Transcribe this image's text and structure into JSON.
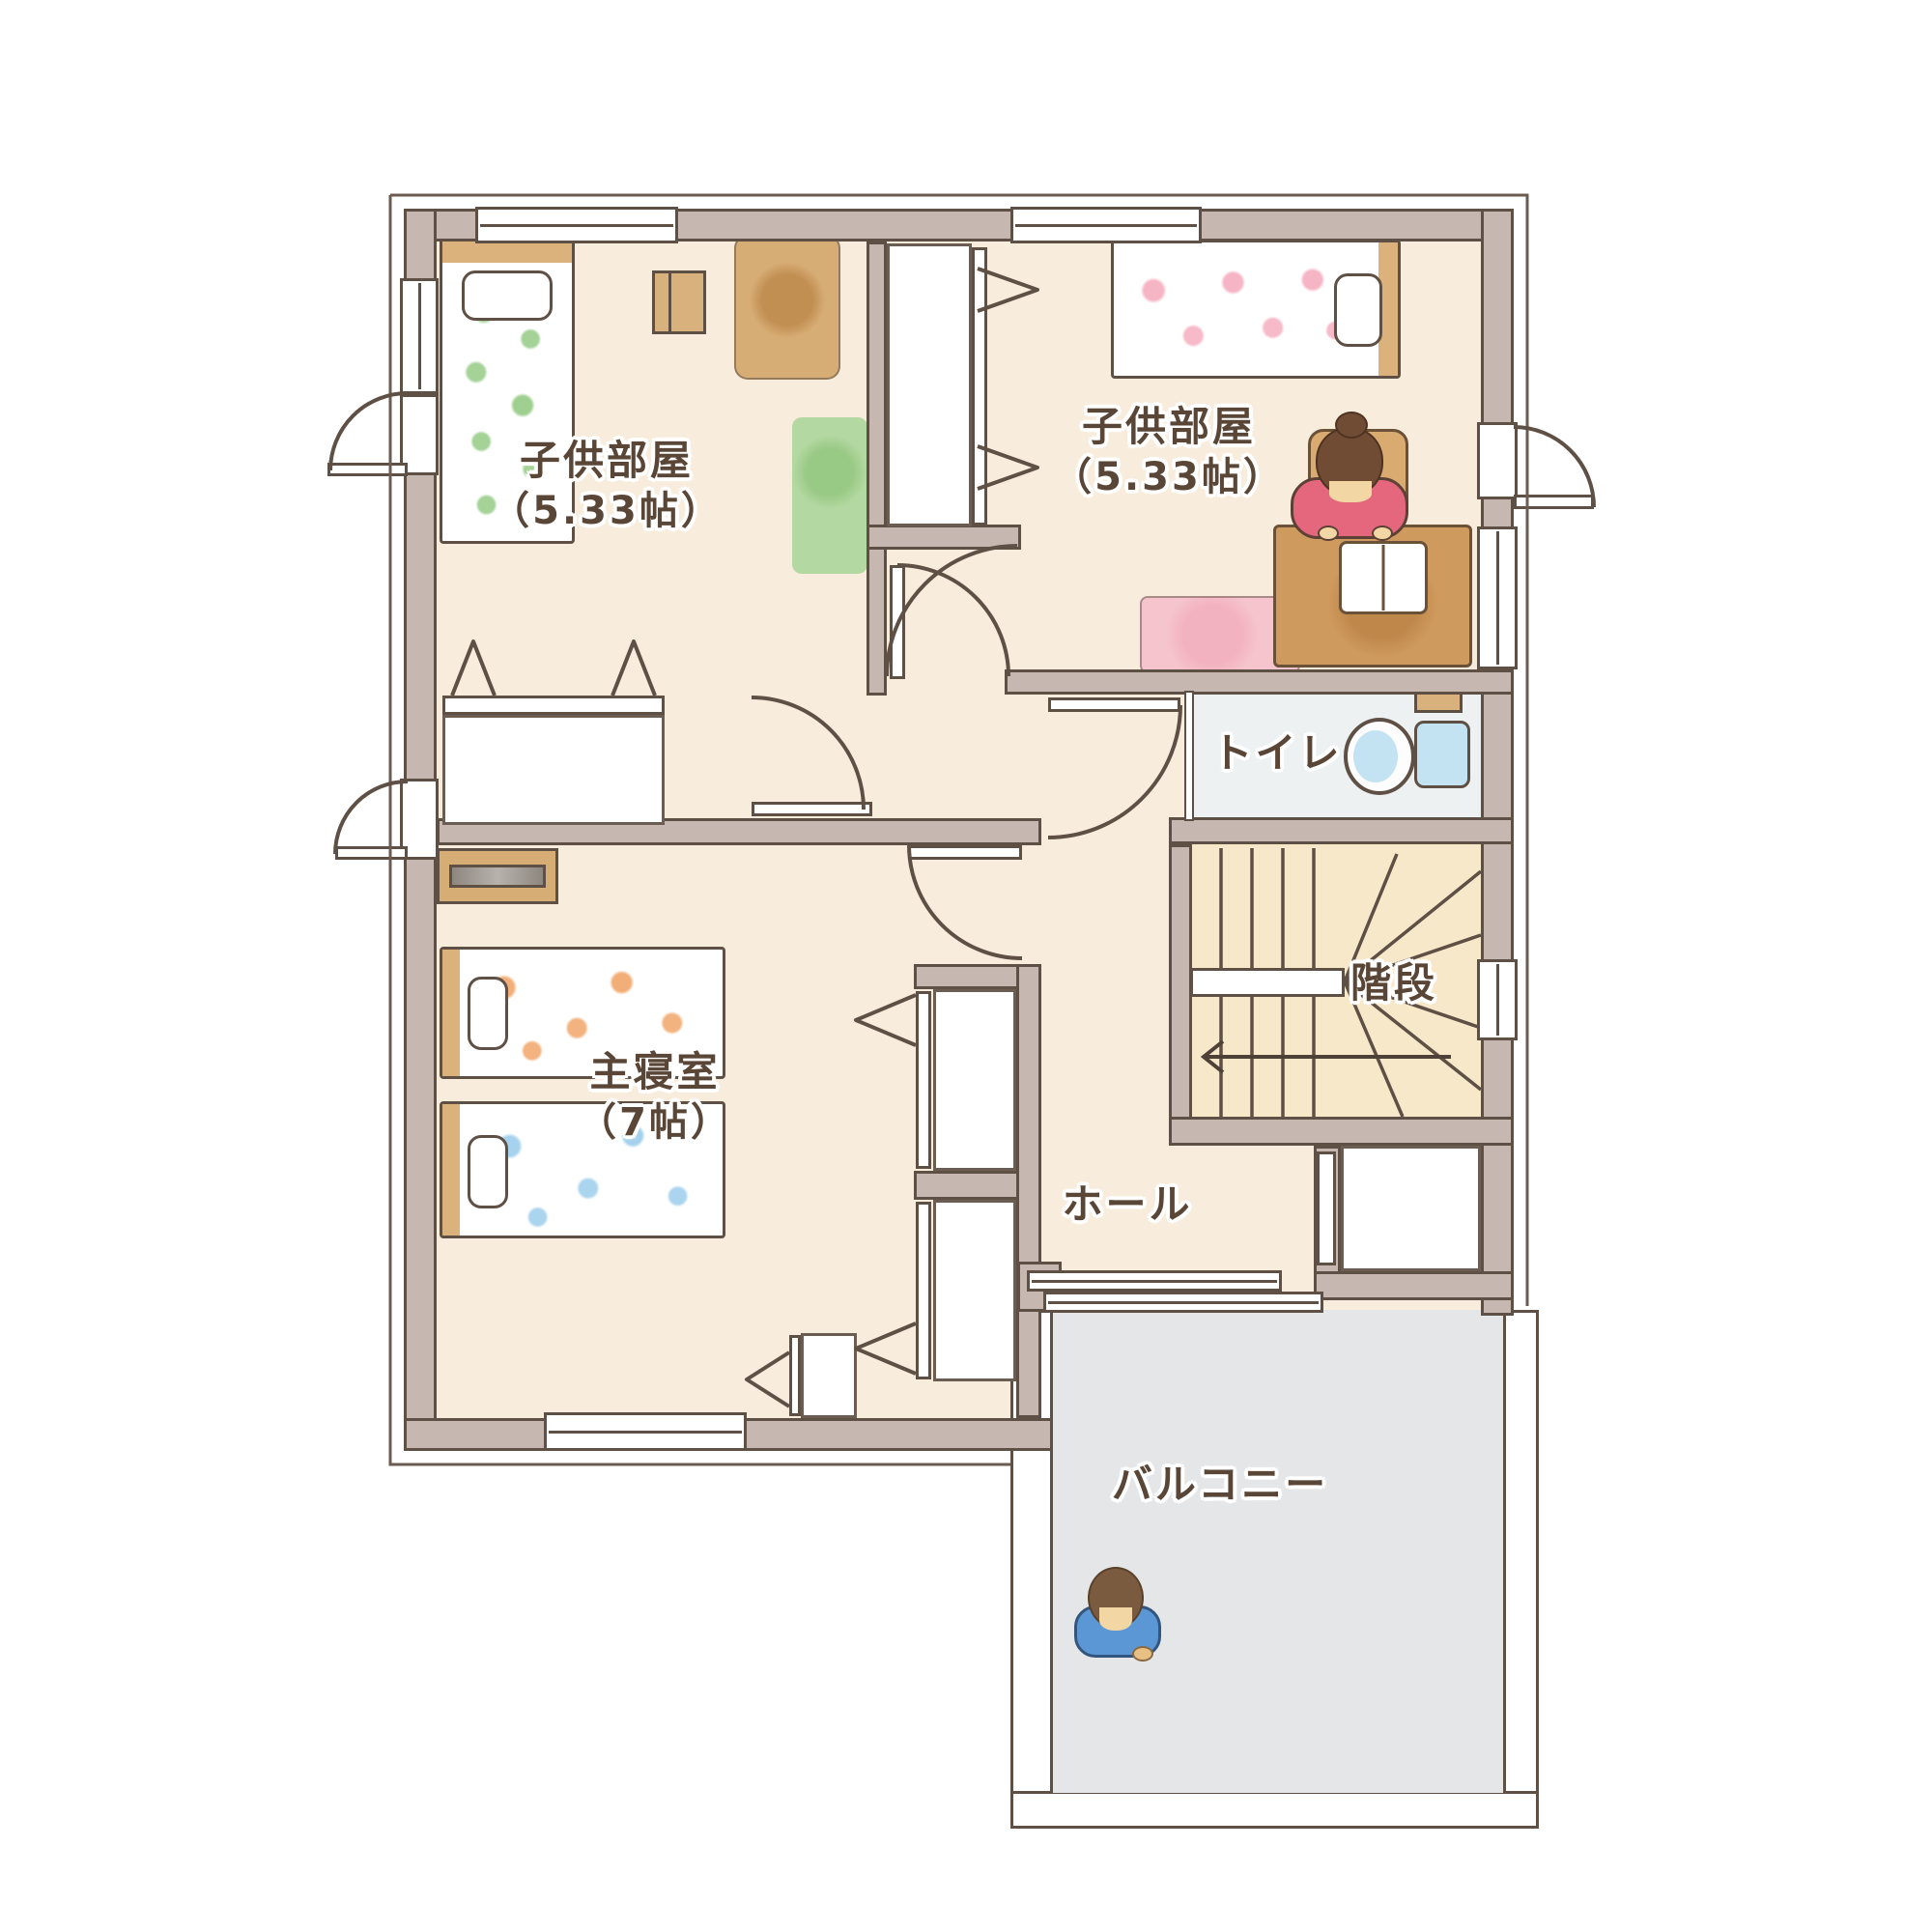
{
  "page_title": "2階間取り図",
  "floor_plan": {
    "rooms": [
      {
        "name": "子供部屋",
        "size": "（5.33帖）"
      },
      {
        "name": "子供部屋",
        "size": "（5.33帖）"
      },
      {
        "name": "主寝室",
        "size": "（7帖）"
      },
      {
        "name": "トイレ",
        "size": ""
      },
      {
        "name": "階段",
        "size": ""
      },
      {
        "name": "ホール",
        "size": ""
      },
      {
        "name": "バルコニー",
        "size": ""
      }
    ],
    "colors": {
      "floor": "#f8ecdd",
      "wall": "#c6b8b1",
      "line": "#5f5046",
      "toilet_floor": "#eef1f1",
      "stairs_floor": "#f7e8ca",
      "balcony_floor": "#e5e6e8",
      "flower_green": "#8ec77d",
      "flower_pink": "#f4a8ba",
      "flower_orange": "#f0a060",
      "flower_blue": "#96caeb",
      "wood": "#d7ad76",
      "desk_brown": "#cf9a5e",
      "rug_green": "#b3d8a1",
      "rug_pink": "#f5c4cd",
      "toilet_blue": "#c3e3f3",
      "girl_shirt": "#e4677e",
      "boy_shirt": "#5b97d4",
      "text": "#5a4636"
    }
  }
}
